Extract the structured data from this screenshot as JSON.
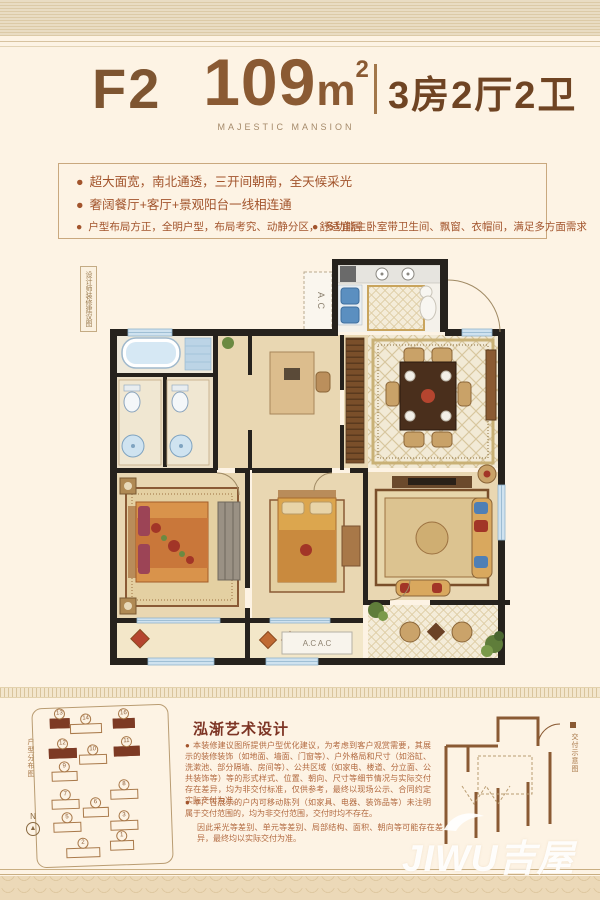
{
  "header": {
    "unit_type": "F2",
    "area_value": "109",
    "area_unit": "m",
    "area_sup": "2",
    "rooms": "3房2厅2卫",
    "brand": "MAJESTIC MANSION"
  },
  "features": {
    "bullet": "●",
    "left": [
      "超大面宽，南北通透，三开间朝南，全天候采光",
      "奢阔餐厅+客厅+景观阳台一线相连通",
      "户型布局方正，全明户型，布局考究、动静分区，舒适宜居"
    ],
    "right": [
      "多功能主卧室带卫生间、飘窗、衣帽间，满足多方面需求"
    ]
  },
  "plan": {
    "side_label": "设计师装修建议图",
    "ac_label": "A.C",
    "ac_double": "A.C  A.C"
  },
  "bottom": {
    "title": "泓渐艺术设计",
    "paragraphs": [
      "本装修建议图所提供户型优化建议，为考虑到客户观赏需要，其展示的装修装饰（如地面、墙面、门窗等）、户外格局和尺寸（如浴缸、洗漱池、部分隔墙、房间等）、公共区域（如家电、楼道、分立面、公共装饰等）等的形式样式、位置、朝向、尺寸等细节情况与实际交付存在差异，均为非交付标准，仅供参考，最终以现场公示、合同约定实际交付为准。",
      "本广告展示的户内可移动陈列（如家具、电器、装饰品等）未注明属于交付范围的，均为非交付范围，交付时均不存在。",
      "因此采光等差别、单元等差别、局部结构、面积、朝向等可能存在差异，最终均以实际交付为准。"
    ],
    "site_plan": {
      "label": "户型分布图",
      "north": "N",
      "buildings": [
        {
          "no": "13",
          "dark": true,
          "x": 26,
          "y": 10,
          "w": 18
        },
        {
          "no": "14",
          "dark": false,
          "x": 52,
          "y": 16,
          "w": 30
        },
        {
          "no": "16",
          "dark": true,
          "x": 90,
          "y": 12,
          "w": 20
        },
        {
          "no": "12",
          "dark": true,
          "x": 28,
          "y": 40,
          "w": 26
        },
        {
          "no": "10",
          "dark": false,
          "x": 58,
          "y": 47,
          "w": 26
        },
        {
          "no": "11",
          "dark": true,
          "x": 92,
          "y": 40,
          "w": 24
        },
        {
          "no": "9",
          "dark": false,
          "x": 29,
          "y": 63,
          "w": 24
        },
        {
          "no": "7",
          "dark": false,
          "x": 29,
          "y": 91,
          "w": 26
        },
        {
          "no": "8",
          "dark": false,
          "x": 88,
          "y": 83,
          "w": 26
        },
        {
          "no": "6",
          "dark": false,
          "x": 59,
          "y": 100,
          "w": 24
        },
        {
          "no": "5",
          "dark": false,
          "x": 30,
          "y": 114,
          "w": 26
        },
        {
          "no": "3",
          "dark": false,
          "x": 87,
          "y": 114,
          "w": 26
        },
        {
          "no": "2",
          "dark": false,
          "x": 45,
          "y": 140,
          "w": 32
        },
        {
          "no": "1",
          "dark": false,
          "x": 84,
          "y": 134,
          "w": 22
        }
      ]
    },
    "delivery": {
      "label": "交付示意图"
    }
  },
  "watermark": {
    "text": "JIWU吉屋"
  },
  "colors": {
    "accent_brown": "#8a5a33",
    "deep_maroon": "#7d3424",
    "feature_red": "#a2542c",
    "wall_black": "#26221d",
    "water_blue": "#5b8fc0",
    "floor_tan": "#e9d7b2"
  }
}
